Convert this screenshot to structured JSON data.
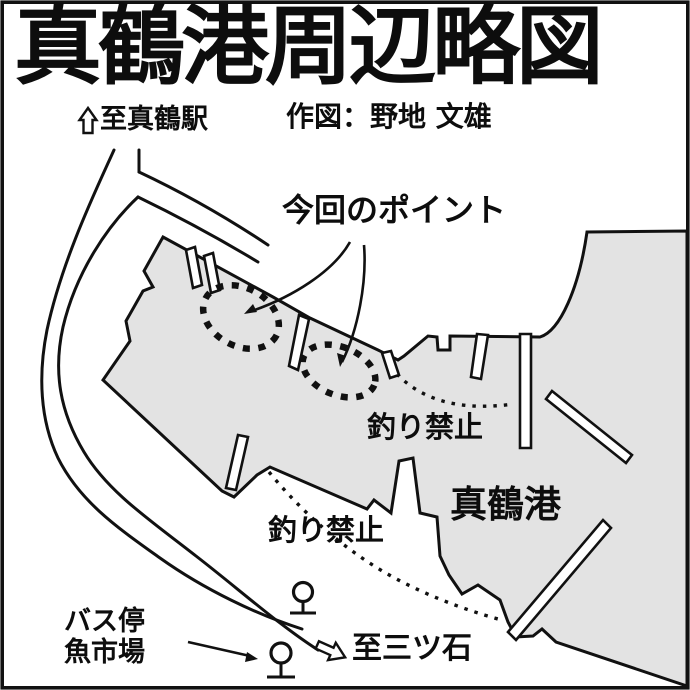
{
  "header": {
    "title": "真鶴港周辺略図",
    "credit": "作図：野地 文雄"
  },
  "map": {
    "to_station_label": "至真鶴駅",
    "point_label": "今回のポイント",
    "no_fishing_label_1": "釣り禁止",
    "no_fishing_label_2": "釣り禁止",
    "port_label": "真鶴港",
    "bus_stop_label_line1": "バス停",
    "bus_stop_label_line2": "魚市場",
    "to_mitsuishi_label": "至三ツ石",
    "fishing_point_count": 2,
    "bus_stop_count": 2,
    "no_fishing_zone_count": 2
  },
  "icons": {
    "to_station_arrow": "hollow-up-arrow",
    "to_mitsuishi_arrow": "hollow-right-down-arrow",
    "bus_stop_symbol": "circle-on-post",
    "fishing_point_marker": "dotted-ellipse",
    "no_fishing_zone_marker": "dotted-arc"
  },
  "colors": {
    "water_fill": "#e3e3e3",
    "line": "#111111",
    "background": "#ffffff"
  }
}
